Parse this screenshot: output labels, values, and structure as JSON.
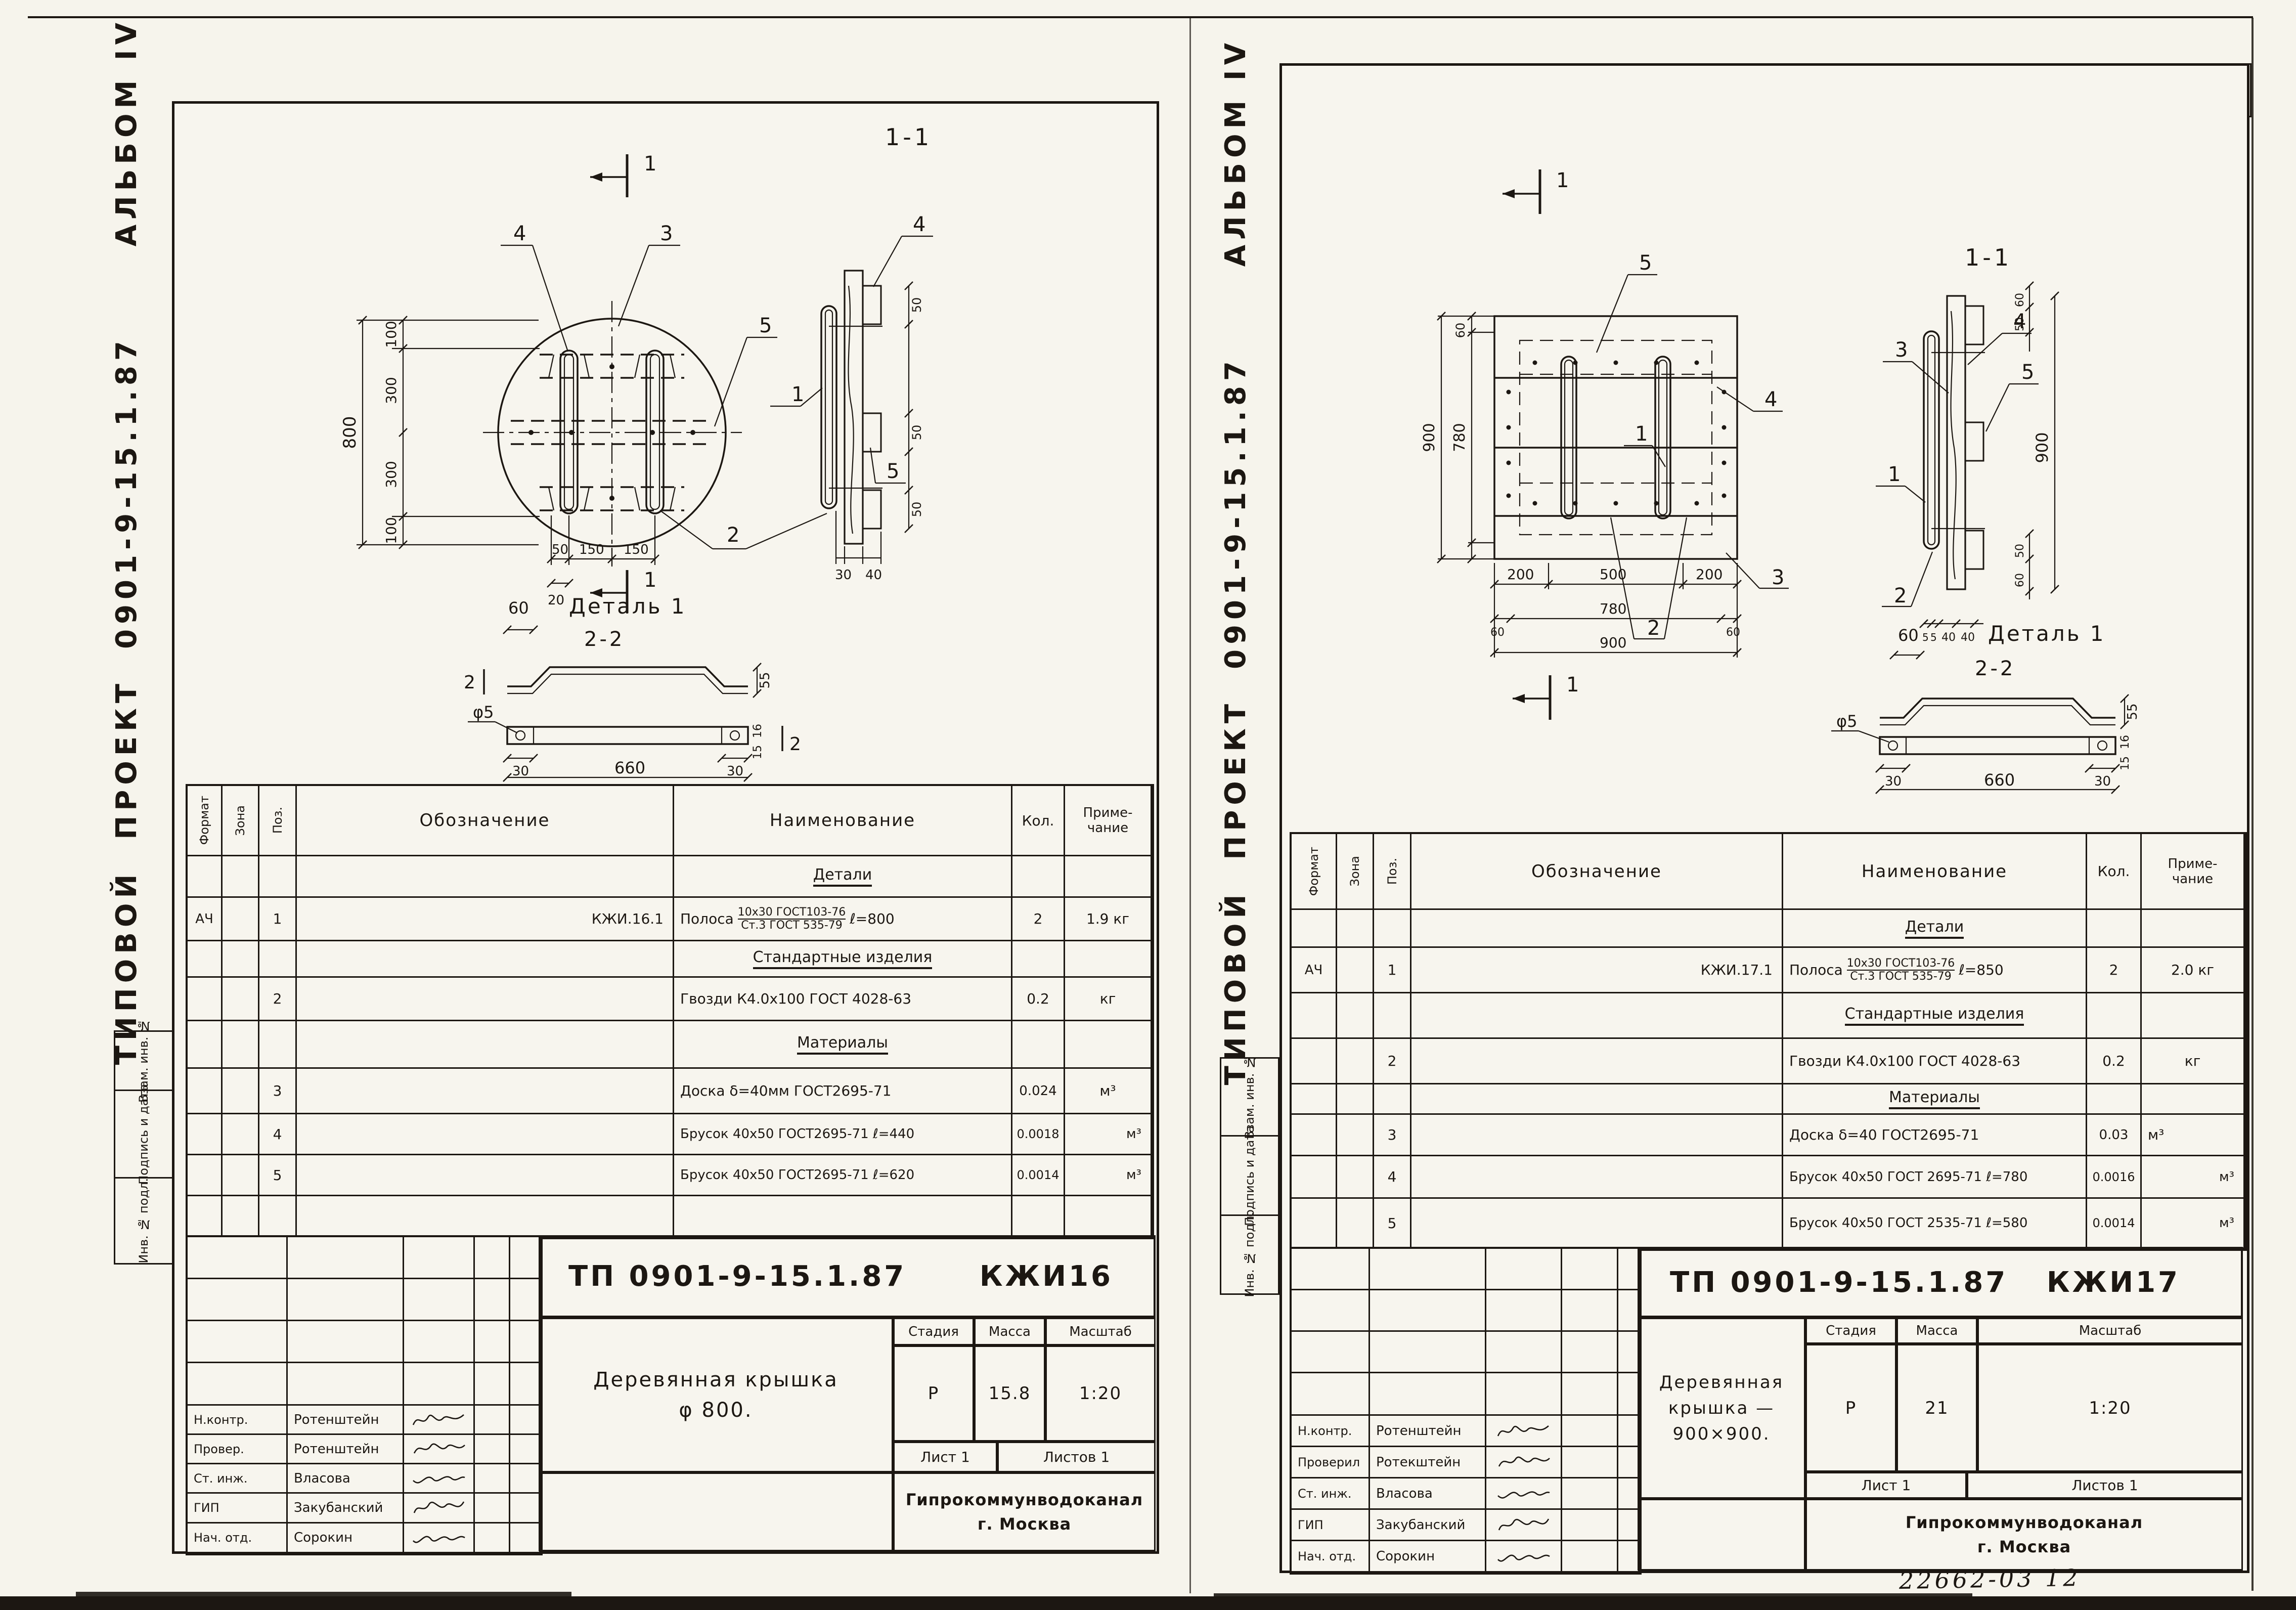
{
  "page": {
    "number": "11",
    "stamp": "22662-03 12"
  },
  "common": {
    "album_title": "ТИПОВОЙ  ПРОЕКТ  0901-9-15.1.87      АЛЬБОМ IV",
    "margin_labels": [
      "Взам. инв. №",
      "Подпись и дата",
      "Инв. № подл."
    ],
    "org": {
      "line1": "Гипрокоммунводоканал",
      "line2": "г. Москва"
    },
    "titleblock": {
      "stage": "Стадия",
      "mass": "Масса",
      "scale": "Масштаб",
      "sheet": "Лист 1",
      "sheets": "Листов 1"
    },
    "table": {
      "format": "Формат",
      "zone": "Зона",
      "pos": "Поз.",
      "designation": "Обозначение",
      "name": "Наименование",
      "qty": "Кол.",
      "note1": "Приме-",
      "note2": "чание",
      "sec_details": "Детали",
      "sec_standard": "Стандартные изделия",
      "sec_materials": "Материалы"
    },
    "dims": {
      "k5": "5",
      "k15": "15",
      "k16": "16",
      "k20": "20",
      "k30": "30",
      "k40": "40",
      "k50": "50",
      "k55": "55",
      "k60": "60",
      "k100": "100",
      "k150": "150",
      "k200": "200",
      "k300": "300",
      "k500": "500",
      "k660": "660",
      "k780": "780",
      "k800": "800",
      "k900": "900",
      "phi5": "φ5",
      "m1": "1",
      "m2": "2",
      "m3": "3",
      "m4": "4",
      "m5": "5",
      "s11": "1-1",
      "s22": "2-2",
      "detail1": "Деталь 1"
    }
  },
  "left": {
    "doc": "ТП 0901-9-15.1.87",
    "code": "КЖИ16",
    "title1": "Деревянная крышка",
    "title2": "φ 800.",
    "stage": "Р",
    "mass": "15.8",
    "scale": "1:20",
    "sig": [
      {
        "role": "Н.контр.",
        "name": "Ротенштейн"
      },
      {
        "role": "Провер.",
        "name": "Ротенштейн"
      },
      {
        "role": "Ст. инж.",
        "name": "Власова"
      },
      {
        "role": "ГИП",
        "name": "Закубанский"
      },
      {
        "role": "Нач. отд.",
        "name": "Сорокин"
      }
    ],
    "polosa": {
      "format": "АЧ",
      "pos": "1",
      "desig": "КЖИ.16.1",
      "pre": "Полоса",
      "ft": "10x30 ГОСТ103-76",
      "fb": "Ст.3 ГОСТ 535-79",
      "suf": "ℓ=800",
      "qty": "2",
      "note": "1.9 кг"
    },
    "rows": {
      "nails": {
        "pos": "2",
        "name": "Гвозди К4.0x100 ГОСТ 4028-63",
        "qty": "0.2",
        "note": "кг"
      },
      "board": {
        "pos": "3",
        "name": "Доска δ=40мм ГОСТ2695-71",
        "qty": "0.024",
        "note": "м³"
      },
      "bar1": {
        "pos": "4",
        "name": "Брусок 40x50 ГОСТ2695-71 ℓ=440",
        "qty": "0.0018",
        "note": "м³"
      },
      "bar2": {
        "pos": "5",
        "name": "Брусок 40x50 ГОСТ2695-71 ℓ=620",
        "qty": "0.0014",
        "note": "м³"
      }
    }
  },
  "right": {
    "doc": "ТП 0901-9-15.1.87",
    "code": "КЖИ17",
    "title1": "Деревянная крышка —",
    "title2": "900×900.",
    "stage": "Р",
    "mass": "21",
    "scale": "1:20",
    "sig": [
      {
        "role": "Н.контр.",
        "name": "Ротенштейн"
      },
      {
        "role": "Проверил",
        "name": "Ротекштейн"
      },
      {
        "role": "Ст. инж.",
        "name": "Власова"
      },
      {
        "role": "ГИП",
        "name": "Закубанский"
      },
      {
        "role": "Нач. отд.",
        "name": "Сорокин"
      }
    ],
    "polosa": {
      "format": "АЧ",
      "pos": "1",
      "desig": "КЖИ.17.1",
      "pre": "Полоса",
      "ft": "10x30 ГОСТ103-76",
      "fb": "Ст.3 ГОСТ 535-79",
      "suf": "ℓ=850",
      "qty": "2",
      "note": "2.0 кг"
    },
    "rows": {
      "nails": {
        "pos": "2",
        "name": "Гвозди К4.0x100 ГОСТ 4028-63",
        "qty": "0.2",
        "note": "кг"
      },
      "board": {
        "pos": "3",
        "name": "Доска δ=40 ГОСТ2695-71",
        "qty": "0.03",
        "note": "м³"
      },
      "bar1": {
        "pos": "4",
        "name": "Брусок 40x50 ГОСТ 2695-71 ℓ=780",
        "qty": "0.0016",
        "note": "м³"
      },
      "bar2": {
        "pos": "5",
        "name": "Брусок 40x50 ГОСТ 2535-71 ℓ=580",
        "qty": "0.0014",
        "note": "м³"
      }
    }
  }
}
